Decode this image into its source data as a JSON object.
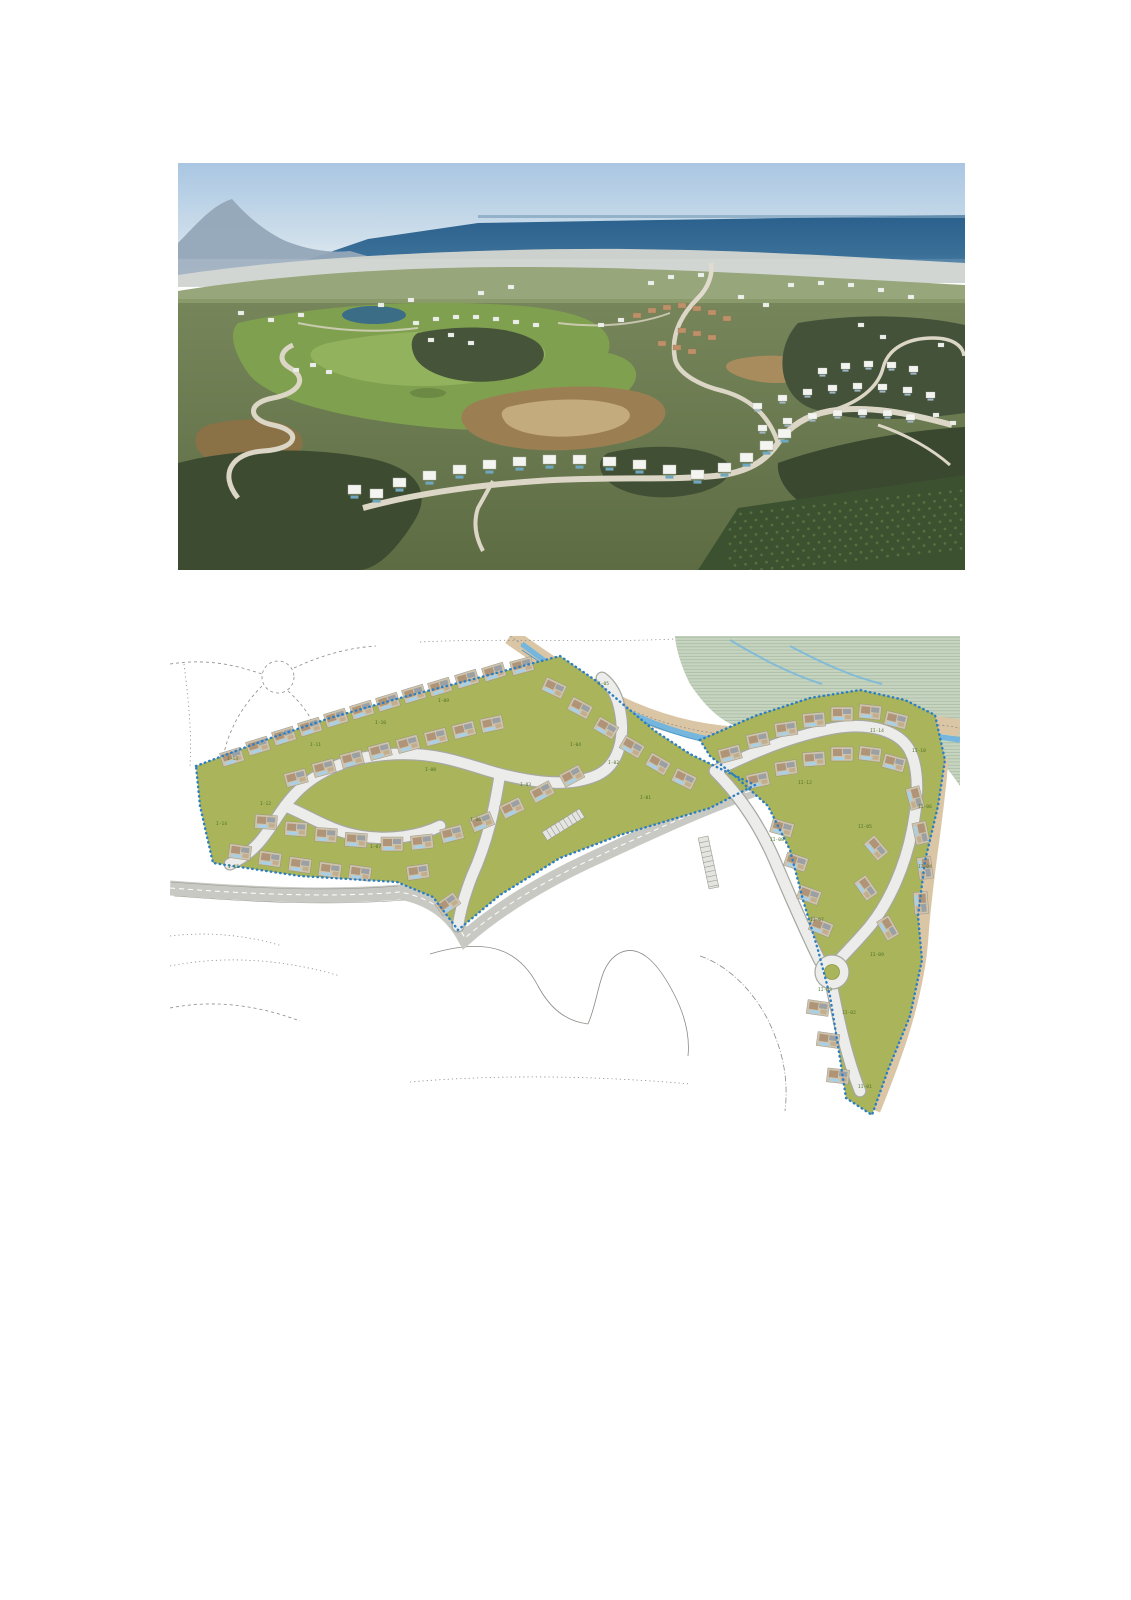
{
  "page": {
    "background": "#ffffff",
    "width": 1131,
    "height": 1600
  },
  "aerial_photo": {
    "alt": "Aerial photograph of a hillside golf resort: rows of white modern villas along winding roads, a golf course with a small lake, scrub-covered hills and orchards, with coastal towns and the Mediterranean sea on the horizon under a clear blue sky",
    "palette": {
      "sky_top": "#a9c6e2",
      "sky_horizon": "#e3ecf1",
      "sea_dark": "#2a608c",
      "sea_light": "#5588ab",
      "distant_land": "#9fb0bf",
      "city_strip": "#ccd1cd",
      "hill_green": "#5d6c43",
      "scrub_dark": "#3d4b31",
      "golf_green": "#7fa04f",
      "lake": "#3b6d86",
      "dirt": "#9b7f53",
      "dirt_light": "#c3ab7d",
      "road": "#dcd6c6",
      "villa_white": "#f3f3ef",
      "orchard": "#3c5130"
    },
    "villas_small": [
      [
        575,
        240
      ],
      [
        600,
        232
      ],
      [
        625,
        226
      ],
      [
        650,
        222
      ],
      [
        675,
        220
      ],
      [
        700,
        221
      ],
      [
        725,
        224
      ],
      [
        748,
        229
      ],
      [
        580,
        262
      ],
      [
        605,
        255
      ],
      [
        630,
        250
      ],
      [
        655,
        247
      ],
      [
        680,
        246
      ],
      [
        705,
        247
      ],
      [
        728,
        251
      ],
      [
        640,
        205
      ],
      [
        663,
        200
      ],
      [
        686,
        198
      ],
      [
        709,
        199
      ],
      [
        731,
        203
      ]
    ],
    "villas_large": [
      [
        215,
        315
      ],
      [
        245,
        308
      ],
      [
        275,
        302
      ],
      [
        305,
        297
      ],
      [
        335,
        294
      ],
      [
        365,
        292
      ],
      [
        395,
        292
      ],
      [
        425,
        294
      ],
      [
        455,
        297
      ],
      [
        485,
        302
      ],
      [
        513,
        307
      ],
      [
        540,
        300
      ],
      [
        562,
        290
      ],
      [
        582,
        278
      ],
      [
        600,
        266
      ],
      [
        192,
        326
      ],
      [
        170,
        322
      ]
    ],
    "distant_buildings": [
      [
        300,
        128
      ],
      [
        330,
        122
      ],
      [
        470,
        118
      ],
      [
        490,
        112
      ],
      [
        520,
        110
      ],
      [
        610,
        120
      ],
      [
        640,
        118
      ],
      [
        670,
        120
      ],
      [
        700,
        125
      ],
      [
        730,
        132
      ],
      [
        200,
        140
      ],
      [
        230,
        135
      ],
      [
        120,
        150
      ],
      [
        90,
        155
      ],
      [
        60,
        148
      ],
      [
        680,
        160
      ],
      [
        702,
        172
      ],
      [
        760,
        180
      ],
      [
        420,
        160
      ],
      [
        440,
        155
      ],
      [
        250,
        175
      ],
      [
        270,
        170
      ],
      [
        290,
        178
      ],
      [
        585,
        140
      ],
      [
        560,
        132
      ],
      [
        235,
        158
      ],
      [
        255,
        154
      ],
      [
        275,
        152
      ],
      [
        295,
        152
      ],
      [
        315,
        154
      ],
      [
        335,
        157
      ],
      [
        355,
        160
      ],
      [
        115,
        205
      ],
      [
        132,
        200
      ],
      [
        148,
        207
      ],
      [
        755,
        250
      ],
      [
        772,
        258
      ]
    ],
    "town_rows": [
      [
        455,
        150
      ],
      [
        470,
        145
      ],
      [
        485,
        142
      ],
      [
        500,
        140
      ],
      [
        515,
        143
      ],
      [
        530,
        147
      ],
      [
        545,
        153
      ],
      [
        500,
        165
      ],
      [
        515,
        168
      ],
      [
        530,
        172
      ],
      [
        480,
        178
      ],
      [
        495,
        182
      ],
      [
        510,
        186
      ]
    ]
  },
  "site_plan": {
    "alt": "Master plan drawing of the development: two olive-green residential phases outlined with a dotted blue boundary, internal looping roads, villa footprints with pools, a roundabout, a stream corridor with riparian zone at the top right and faint existing-terrain lines around",
    "palette": {
      "parcel": "#a9b45b",
      "boundary": "#2e7fc2",
      "road_fill": "#ececea",
      "road_edge": "#a8a8a2",
      "existing_road": "#c9c9c4",
      "stream": "#74b6de",
      "stream_line": "#4d9bca",
      "riparian": "#c6d4c0",
      "riparian_hatch": "#a3b89f",
      "sand_path": "#dac5a5",
      "context_line": "#8a8a86",
      "label": "#4f7426",
      "pool": "#a8d0e6",
      "roof_tan": "#cfc3ab",
      "roof_brown": "#b09478",
      "roof_grey": "#9aa0a4"
    },
    "plot_labels": [
      {
        "text": "I-13",
        "x": 57,
        "y": 124
      },
      {
        "text": "I-12",
        "x": 90,
        "y": 169
      },
      {
        "text": "I-14",
        "x": 46,
        "y": 189
      },
      {
        "text": "I-15",
        "x": 58,
        "y": 232
      },
      {
        "text": "I-11",
        "x": 140,
        "y": 110
      },
      {
        "text": "I-10",
        "x": 205,
        "y": 88
      },
      {
        "text": "I-09",
        "x": 268,
        "y": 66
      },
      {
        "text": "I-08",
        "x": 255,
        "y": 135
      },
      {
        "text": "I-07",
        "x": 200,
        "y": 212
      },
      {
        "text": "I-06",
        "x": 300,
        "y": 185
      },
      {
        "text": "I-05",
        "x": 428,
        "y": 49
      },
      {
        "text": "I-04",
        "x": 400,
        "y": 110
      },
      {
        "text": "I-03",
        "x": 350,
        "y": 150
      },
      {
        "text": "I-02",
        "x": 438,
        "y": 128
      },
      {
        "text": "I-01",
        "x": 470,
        "y": 163
      },
      {
        "text": "II-14",
        "x": 700,
        "y": 96
      },
      {
        "text": "II-12",
        "x": 628,
        "y": 148
      },
      {
        "text": "II-10",
        "x": 742,
        "y": 116
      },
      {
        "text": "II-08",
        "x": 600,
        "y": 205
      },
      {
        "text": "II-06",
        "x": 748,
        "y": 172
      },
      {
        "text": "II-05",
        "x": 688,
        "y": 192
      },
      {
        "text": "II-04",
        "x": 748,
        "y": 232
      },
      {
        "text": "II-07",
        "x": 640,
        "y": 285
      },
      {
        "text": "II-09",
        "x": 700,
        "y": 320
      },
      {
        "text": "II-03",
        "x": 648,
        "y": 355
      },
      {
        "text": "II-02",
        "x": 672,
        "y": 378
      },
      {
        "text": "II-01",
        "x": 688,
        "y": 452
      }
    ],
    "villas": [
      [
        62,
        121,
        -17
      ],
      [
        88,
        110,
        -17
      ],
      [
        114,
        100,
        -17
      ],
      [
        140,
        91,
        -17
      ],
      [
        166,
        82,
        -17
      ],
      [
        192,
        74,
        -17
      ],
      [
        218,
        66,
        -17
      ],
      [
        244,
        58,
        -17
      ],
      [
        270,
        51,
        -17
      ],
      [
        297,
        43,
        -17
      ],
      [
        324,
        36,
        -17
      ],
      [
        352,
        30,
        -15
      ],
      [
        384,
        52,
        25
      ],
      [
        410,
        72,
        28
      ],
      [
        436,
        92,
        30
      ],
      [
        462,
        111,
        30
      ],
      [
        488,
        128,
        30
      ],
      [
        514,
        143,
        26
      ],
      [
        126,
        142,
        -15
      ],
      [
        154,
        132,
        -15
      ],
      [
        182,
        123,
        -15
      ],
      [
        210,
        115,
        -15
      ],
      [
        238,
        108,
        -15
      ],
      [
        266,
        101,
        -14
      ],
      [
        294,
        94,
        -14
      ],
      [
        322,
        88,
        -12
      ],
      [
        96,
        186,
        4
      ],
      [
        126,
        193,
        4
      ],
      [
        156,
        199,
        4
      ],
      [
        186,
        204,
        4
      ],
      [
        70,
        216,
        8
      ],
      [
        100,
        223,
        8
      ],
      [
        130,
        229,
        8
      ],
      [
        160,
        234,
        8
      ],
      [
        190,
        237,
        8
      ],
      [
        222,
        208,
        0
      ],
      [
        252,
        206,
        -6
      ],
      [
        282,
        198,
        -14
      ],
      [
        312,
        186,
        -22
      ],
      [
        342,
        172,
        -26
      ],
      [
        372,
        156,
        -28
      ],
      [
        402,
        140,
        -28
      ],
      [
        248,
        236,
        -8
      ],
      [
        278,
        268,
        -35
      ],
      [
        560,
        118,
        -15
      ],
      [
        588,
        104,
        -12
      ],
      [
        616,
        93,
        -8
      ],
      [
        644,
        84,
        -5
      ],
      [
        672,
        78,
        0
      ],
      [
        700,
        76,
        6
      ],
      [
        726,
        84,
        14
      ],
      [
        588,
        144,
        -12
      ],
      [
        616,
        132,
        -8
      ],
      [
        644,
        123,
        -4
      ],
      [
        672,
        118,
        0
      ],
      [
        700,
        118,
        7
      ],
      [
        724,
        127,
        15
      ],
      [
        745,
        162,
        75
      ],
      [
        751,
        197,
        78
      ],
      [
        755,
        232,
        82
      ],
      [
        751,
        267,
        86
      ],
      [
        612,
        192,
        16
      ],
      [
        626,
        226,
        18
      ],
      [
        639,
        259,
        20
      ],
      [
        651,
        291,
        22
      ],
      [
        706,
        212,
        50
      ],
      [
        696,
        252,
        55
      ],
      [
        718,
        292,
        60
      ],
      [
        648,
        372,
        8
      ],
      [
        658,
        404,
        8
      ],
      [
        668,
        440,
        6
      ]
    ]
  }
}
